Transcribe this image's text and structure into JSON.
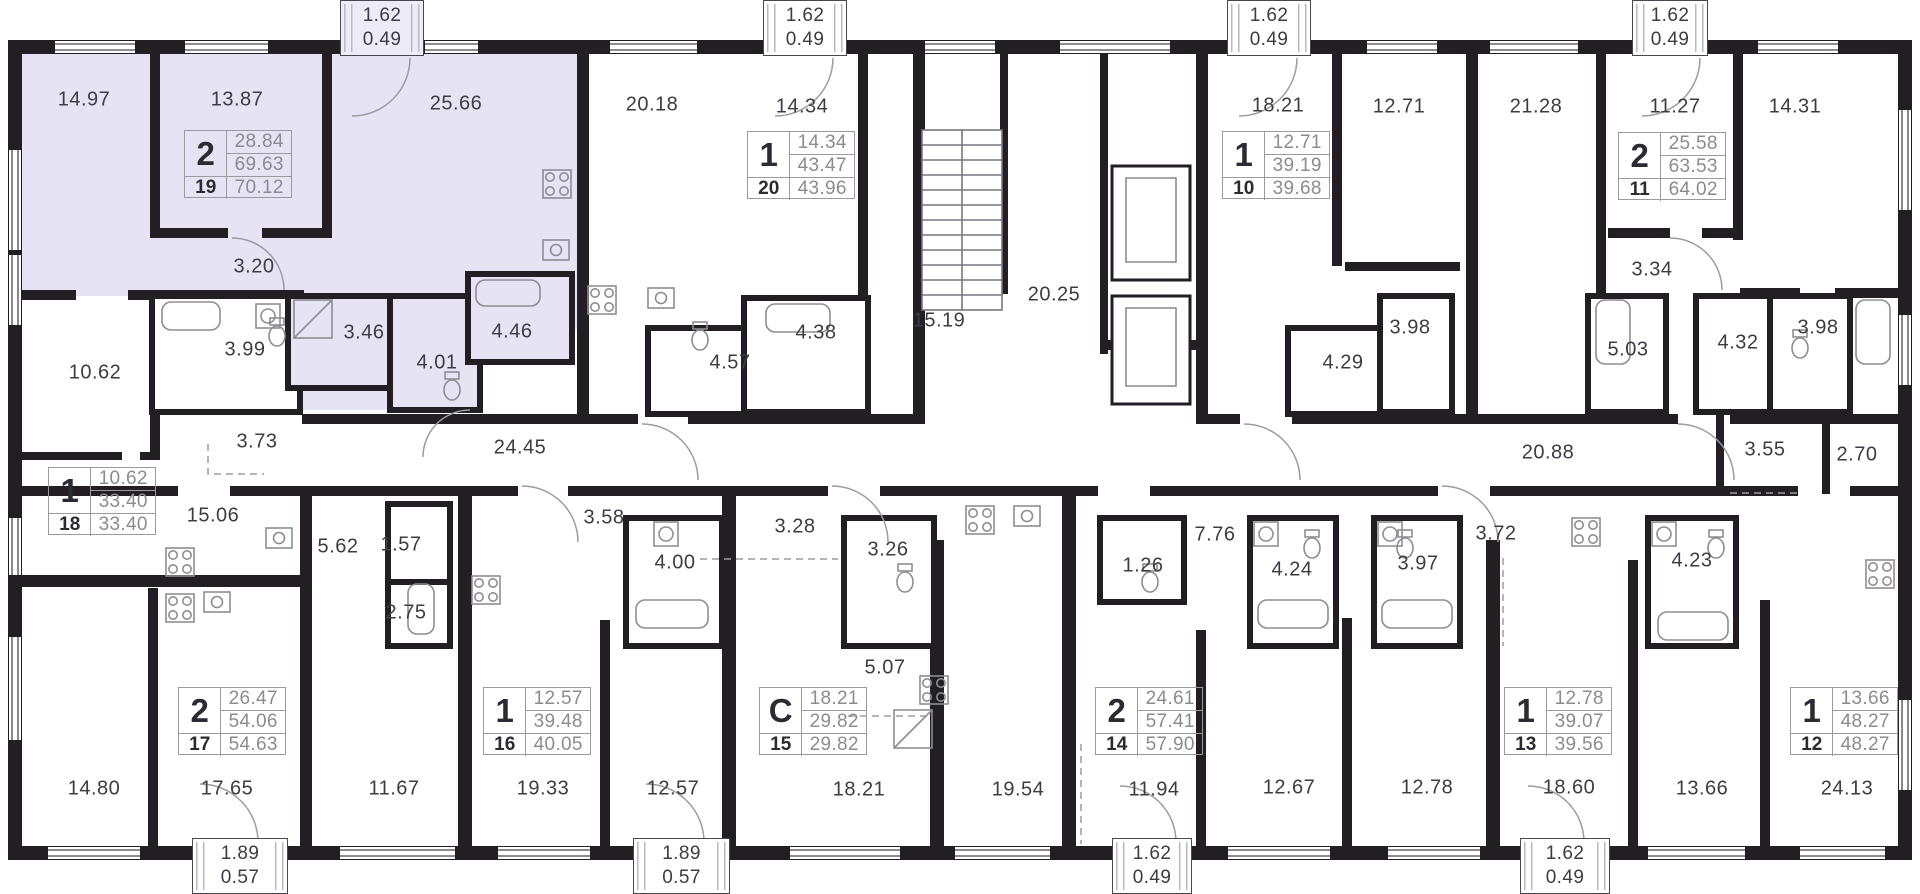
{
  "plan": {
    "wall_color": "#221e24",
    "highlight_color": "#e6e3f5",
    "label_color": "#3c3c44",
    "highlighted_apartment_number": "19"
  },
  "labels": [
    {
      "value": "14.97",
      "x": 84,
      "y": 100
    },
    {
      "value": "13.87",
      "x": 237,
      "y": 100
    },
    {
      "value": "25.66",
      "x": 456,
      "y": 104
    },
    {
      "value": "20.18",
      "x": 652,
      "y": 105
    },
    {
      "value": "14.34",
      "x": 802,
      "y": 107
    },
    {
      "value": "15.19",
      "x": 939,
      "y": 321
    },
    {
      "value": "20.25",
      "x": 1054,
      "y": 295
    },
    {
      "value": "18.21",
      "x": 1278,
      "y": 106
    },
    {
      "value": "12.71",
      "x": 1399,
      "y": 107
    },
    {
      "value": "21.28",
      "x": 1536,
      "y": 107
    },
    {
      "value": "11.27",
      "x": 1675,
      "y": 107
    },
    {
      "value": "14.31",
      "x": 1795,
      "y": 107
    },
    {
      "value": "3.20",
      "x": 254,
      "y": 267
    },
    {
      "value": "3.99",
      "x": 245,
      "y": 350
    },
    {
      "value": "3.46",
      "x": 364,
      "y": 333
    },
    {
      "value": "4.01",
      "x": 437,
      "y": 363
    },
    {
      "value": "4.46",
      "x": 512,
      "y": 332
    },
    {
      "value": "10.62",
      "x": 95,
      "y": 373
    },
    {
      "value": "3.73",
      "x": 257,
      "y": 442
    },
    {
      "value": "24.45",
      "x": 520,
      "y": 448
    },
    {
      "value": "4.57",
      "x": 730,
      "y": 363
    },
    {
      "value": "4.38",
      "x": 816,
      "y": 333
    },
    {
      "value": "3.34",
      "x": 1652,
      "y": 270
    },
    {
      "value": "4.29",
      "x": 1343,
      "y": 363
    },
    {
      "value": "3.98",
      "x": 1410,
      "y": 328
    },
    {
      "value": "5.03",
      "x": 1628,
      "y": 350
    },
    {
      "value": "4.32",
      "x": 1738,
      "y": 343
    },
    {
      "value": "3.98",
      "x": 1818,
      "y": 328
    },
    {
      "value": "20.88",
      "x": 1548,
      "y": 453
    },
    {
      "value": "3.55",
      "x": 1765,
      "y": 450
    },
    {
      "value": "2.70",
      "x": 1857,
      "y": 455
    },
    {
      "value": "15.06",
      "x": 213,
      "y": 516
    },
    {
      "value": "5.62",
      "x": 338,
      "y": 547
    },
    {
      "value": "1.57",
      "x": 401,
      "y": 545
    },
    {
      "value": "2.75",
      "x": 406,
      "y": 613
    },
    {
      "value": "3.58",
      "x": 604,
      "y": 518
    },
    {
      "value": "4.00",
      "x": 675,
      "y": 563
    },
    {
      "value": "3.28",
      "x": 795,
      "y": 527
    },
    {
      "value": "3.26",
      "x": 888,
      "y": 550
    },
    {
      "value": "5.07",
      "x": 885,
      "y": 668
    },
    {
      "value": "1.26",
      "x": 1143,
      "y": 566
    },
    {
      "value": "7.76",
      "x": 1215,
      "y": 535
    },
    {
      "value": "4.24",
      "x": 1292,
      "y": 570
    },
    {
      "value": "3.97",
      "x": 1418,
      "y": 564
    },
    {
      "value": "3.72",
      "x": 1496,
      "y": 534
    },
    {
      "value": "4.23",
      "x": 1692,
      "y": 561
    },
    {
      "value": "14.80",
      "x": 94,
      "y": 789
    },
    {
      "value": "17.65",
      "x": 227,
      "y": 789
    },
    {
      "value": "11.67",
      "x": 394,
      "y": 789
    },
    {
      "value": "19.33",
      "x": 543,
      "y": 789
    },
    {
      "value": "12.57",
      "x": 673,
      "y": 789
    },
    {
      "value": "18.21",
      "x": 859,
      "y": 790
    },
    {
      "value": "19.54",
      "x": 1018,
      "y": 790
    },
    {
      "value": "11.94",
      "x": 1154,
      "y": 790
    },
    {
      "value": "12.67",
      "x": 1289,
      "y": 788
    },
    {
      "value": "12.78",
      "x": 1427,
      "y": 788
    },
    {
      "value": "18.60",
      "x": 1569,
      "y": 788
    },
    {
      "value": "13.66",
      "x": 1702,
      "y": 789
    },
    {
      "value": "24.13",
      "x": 1847,
      "y": 789
    }
  ],
  "apartment_tables": [
    {
      "rooms": "2",
      "living_area": "28.84",
      "area": "69.63",
      "number": "19",
      "total_area": "70.12",
      "x": 184,
      "y": 130
    },
    {
      "rooms": "1",
      "living_area": "14.34",
      "area": "43.47",
      "number": "20",
      "total_area": "43.96",
      "x": 747,
      "y": 131
    },
    {
      "rooms": "1",
      "living_area": "12.71",
      "area": "39.19",
      "number": "10",
      "total_area": "39.68",
      "x": 1222,
      "y": 131
    },
    {
      "rooms": "2",
      "living_area": "25.58",
      "area": "63.53",
      "number": "11",
      "total_area": "64.02",
      "x": 1618,
      "y": 132
    },
    {
      "rooms": "1",
      "living_area": "10.62",
      "area": "33.40",
      "number": "18",
      "total_area": "33.40",
      "x": 48,
      "y": 467
    },
    {
      "rooms": "2",
      "living_area": "26.47",
      "area": "54.06",
      "number": "17",
      "total_area": "54.63",
      "x": 178,
      "y": 687
    },
    {
      "rooms": "1",
      "living_area": "12.57",
      "area": "39.48",
      "number": "16",
      "total_area": "40.05",
      "x": 483,
      "y": 687
    },
    {
      "rooms": "C",
      "living_area": "18.21",
      "area": "29.82",
      "number": "15",
      "total_area": "29.82",
      "x": 759,
      "y": 687
    },
    {
      "rooms": "2",
      "living_area": "24.61",
      "area": "57.41",
      "number": "14",
      "total_area": "57.90",
      "x": 1095,
      "y": 687
    },
    {
      "rooms": "1",
      "living_area": "12.78",
      "area": "39.07",
      "number": "13",
      "total_area": "39.56",
      "x": 1504,
      "y": 687
    },
    {
      "rooms": "1",
      "living_area": "13.66",
      "area": "48.27",
      "number": "12",
      "total_area": "48.27",
      "x": 1790,
      "y": 687
    }
  ],
  "balconies": [
    {
      "area": "1.62",
      "reduced_area": "0.49",
      "x": 340,
      "y": 0,
      "w": 84,
      "h": 56,
      "position": "top",
      "highlighted": true
    },
    {
      "area": "1.62",
      "reduced_area": "0.49",
      "x": 763,
      "y": 0,
      "w": 84,
      "h": 56,
      "position": "top",
      "highlighted": false
    },
    {
      "area": "1.62",
      "reduced_area": "0.49",
      "x": 1227,
      "y": 0,
      "w": 84,
      "h": 56,
      "position": "top",
      "highlighted": false
    },
    {
      "area": "1.62",
      "reduced_area": "0.49",
      "x": 1632,
      "y": 0,
      "w": 76,
      "h": 56,
      "position": "top",
      "highlighted": false
    },
    {
      "area": "1.89",
      "reduced_area": "0.57",
      "x": 192,
      "y": 838,
      "w": 96,
      "h": 56,
      "position": "bottom",
      "highlighted": false
    },
    {
      "area": "1.89",
      "reduced_area": "0.57",
      "x": 633,
      "y": 838,
      "w": 97,
      "h": 56,
      "position": "bottom",
      "highlighted": false
    },
    {
      "area": "1.62",
      "reduced_area": "0.49",
      "x": 1112,
      "y": 838,
      "w": 80,
      "h": 56,
      "position": "bottom",
      "highlighted": false
    },
    {
      "area": "1.62",
      "reduced_area": "0.49",
      "x": 1520,
      "y": 838,
      "w": 90,
      "h": 56,
      "position": "bottom",
      "highlighted": false
    }
  ]
}
